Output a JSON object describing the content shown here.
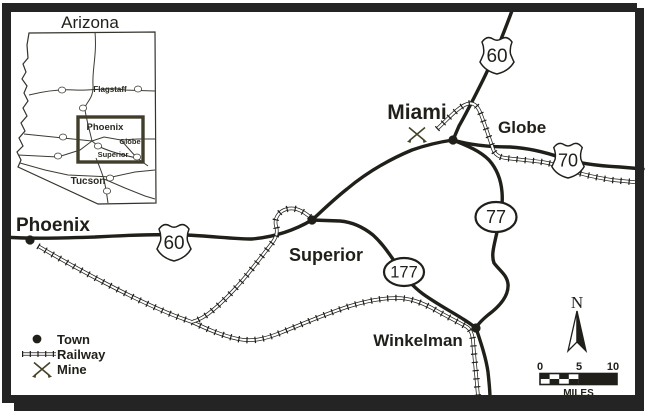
{
  "map": {
    "towns": {
      "phoenix": "Phoenix",
      "superior": "Superior",
      "miami": "Miami",
      "globe": "Globe",
      "winkelman": "Winkelman"
    },
    "shields": {
      "us60": "60",
      "us70": "70",
      "sr77": "77",
      "sr177": "177"
    }
  },
  "inset": {
    "title": "Arizona",
    "labels": {
      "flagstaff": "Flagstaff",
      "phoenix": "Phoenix",
      "globe": "Globe",
      "superior": "Superior",
      "tucson": "Tucson"
    }
  },
  "legend": {
    "town": "Town",
    "railway": "Railway",
    "mine": "Mine"
  },
  "compass": {
    "north": "N"
  },
  "scale": {
    "start": "0",
    "mid": "5",
    "end": "10",
    "unit": "MILES"
  },
  "colors": {
    "ink": "#201f1a",
    "olive": "#454229",
    "title_gray": "#4f4e46",
    "background": "#ffffff"
  }
}
